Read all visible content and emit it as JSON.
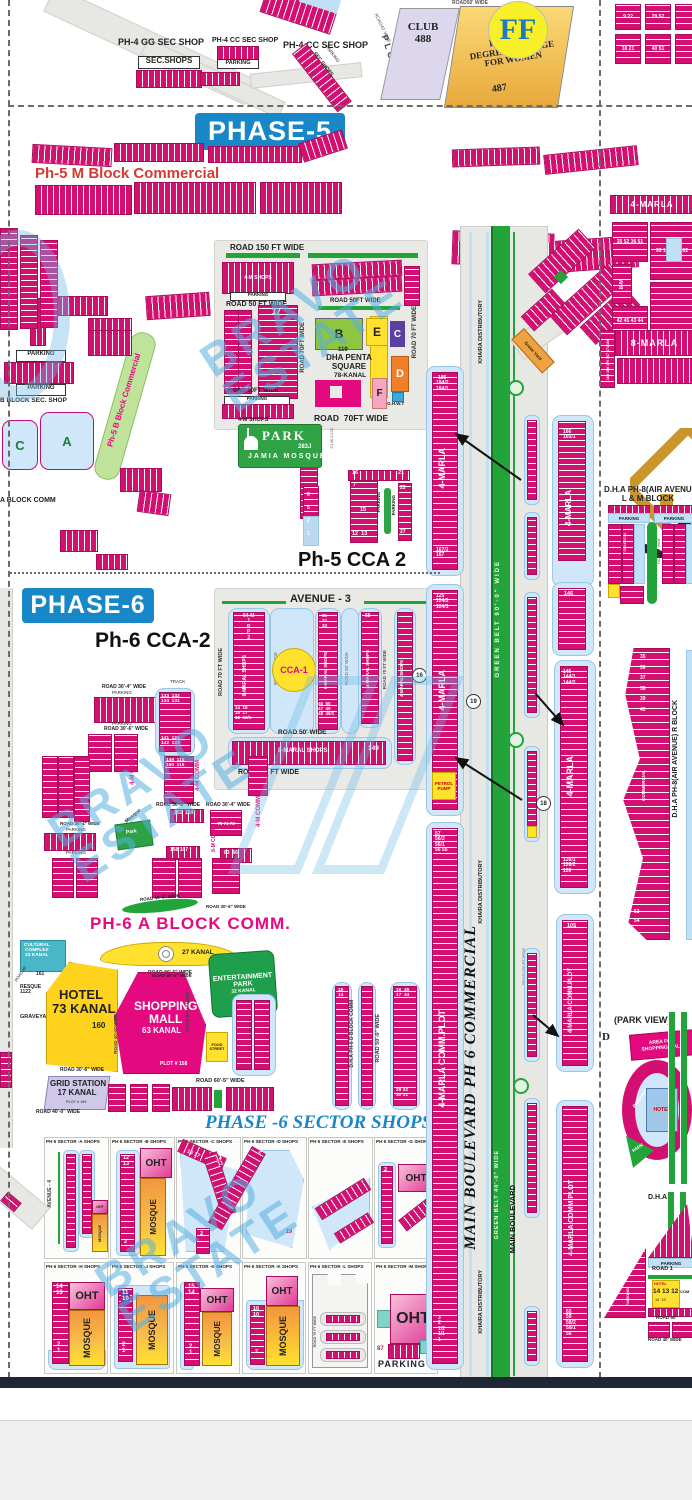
{
  "c": {
    "parking": "PARKING",
    "oht": "OHT",
    "mosque": "MOSQUE",
    "marla4": "4-MARLA",
    "marla8": "8-MARLA",
    "marla_comm": "4-MARLA COMM.PLOT",
    "khaira": "KHAIRA DISTRIBUTORY",
    "comm": "COMMERCIAL",
    "m4comm": "4-M COMM",
    "m8comm": "8-M COMM",
    "shops4m": "4-M SHOPS",
    "secshops": "SEC SHOPS"
  },
  "top": {
    "gg": "PH-4 GG SEC SHOP",
    "secshops": "SEC.SHOPS",
    "cc": "PH-4 CC SEC SHOP",
    "plots": "PLOTS",
    "club": "CLUB\n488",
    "road50": "ROAD50' WIDE",
    "road40": "ROAD40' WIDE",
    "college": "DEFENCE\nDEGREE COLLAGE\nFOR WOMEN",
    "college_num": "487",
    "ff": "FF",
    "g1": "18 21",
    "g2": "40 51",
    "g3": "9 22",
    "g4": "29 52"
  },
  "p5": {
    "title": "PHASE-5",
    "mblock": "Ph-5 M Block Commercial",
    "bblock": "Ph-5 B Block Commercial",
    "bsec": "B BLOCK SEC. SHOP",
    "ablock": "A BLOCK COMM",
    "cletter": "C",
    "aletter": "A",
    "road150": "ROAD 150 FT WIDE",
    "road50": "ROAD 50 FT WIDE",
    "road50v": "ROAD 50FT WIDE",
    "road70v": "ROAD 70FT WIDE",
    "road70": "ROAD  70FT WIDE",
    "road70r": "ROAD 70 FT WIDE",
    "cca": "CCA",
    "n17": "17"
  },
  "penta": {
    "num": "119",
    "name": "DHA PENTA\nSQUARE",
    "kanal": "78-KANAL",
    "pa": "A",
    "pb": "B",
    "pc": "C",
    "pd": "D",
    "pe": "E",
    "pf": "F",
    "ohwt": "O.H.W.T"
  },
  "park5": {
    "park": "PARK",
    "num": "283J",
    "mosque": "JAMIA MOSQUE",
    "c146": "C146-C125"
  },
  "cca25": {
    "title": "Ph-5 CCA 2",
    "n16": "16",
    "n21": "21",
    "n7": "7",
    "n15": "15",
    "n1213": "12  13",
    "n23": "23",
    "n27": "27",
    "col": "6\n5\n2\n1"
  },
  "p6": {
    "title": "PHASE-6",
    "cca2": "Ph-6 CCA-2",
    "avenue3": "AVENUE - 3",
    "cca1": "CCA-1",
    "track": "TRACK",
    "road304": "ROAD 30'-4\" WIDE",
    "road306": "ROAD 30'-6\" WIDE",
    "road70": "ROAD 70 FT WIDE",
    "road50": "ROAD 50' WIDE",
    "shops8m": "8-MARAL SHOPS",
    "shops4m": "4-MARAL SHOPS",
    "c1top": "64-M\n1\nP\nP\n2",
    "c1bot": "14  18\n15  17\n16  16/1",
    "c3top": "31\n32\n33",
    "c3bot": "46  50\n47  49\n48  46/1",
    "n65": "65",
    "n149": "149",
    "n16": "16",
    "blkA": "133  132\n134  131",
    "blkB": "141  124\n142  123",
    "blkC": "149  116\n150  115",
    "n151": "151  114",
    "n75": "75  74  73",
    "n83": "83  66",
    "n158": "158 107",
    "mosque": "Mosque",
    "park": "Park",
    "road500": "ROAD 50'-0\" WIDE",
    "dblock": "D.H.A PH-6 D BLOCK COMM",
    "d1": "15\n14",
    "d2": "16  45\n17  44",
    "d3": "29 32\n30 31"
  },
  "lm": {
    "ablock": "PH-6 A BLOCK COMM.",
    "cultural": "CULTURAL\nCOMPLEX\n23 KANAL",
    "cultural_num": "161",
    "kanal27": "27 KANAL",
    "road806": "ROAD 80'-6\" WIDE",
    "ent": "ENTERTAINMENT\nPARK",
    "ent_k": "32 KANAL",
    "resque": "RESQUE\n1122",
    "graveyard": "GRAVEYARD",
    "road40": "ROAD 40'",
    "hotel": "HOTEL\n73 KANAL",
    "hotel_num": "160",
    "mall": "SHOPPING\nMALL",
    "mall_k": "63 KANAL",
    "mall_plot": "PLOT # 158",
    "grid": "GRID STATION\n17 KANAL",
    "grid_plot": "PLOT # 159",
    "road306": "ROAD 30'-6\" WIDE",
    "road400": "ROAD 40'-0\" WIDE",
    "road605": "ROAD 60'-5\" WIDE",
    "food": "FOOD\nSTREET"
  },
  "ss": {
    "title": "PHASE -6 SECTOR SHOPS",
    "pa": "PH 6 SECTOR -A SHOPS",
    "pb": "PH 6 SECTOR -B SHOPS",
    "pc": "PH 6 SECTOR -C SHOPS",
    "pd": "PH 6 SECTOR -D SHOPS",
    "pe": "PH 6 SECTOR -E SHOPS",
    "pg": "PH 6 SECTOR -G SHOPS",
    "ph": "PH 6 SECTOR -H SHOPS",
    "pj": "PH 6 SECTOR -J SHOPS",
    "pk": "PH 6 SECTOR -K SHOPS",
    "pk2": "PH 6 SECTOR -K SHOPS",
    "pl": "PH 6 SECTOR -L SHOPS",
    "pm": "PH 6 SECTOR -M SHOPS",
    "avenue4": "AVENUE - 4",
    "b_top": "12\n13",
    "b_bot": "2",
    "c_n1": "16 17",
    "c_n2": "12\n11",
    "c_bot": "2",
    "d_top": "2",
    "d_bot": "19",
    "e_n": "2 1",
    "g_top": "2",
    "h_top": "14\n13",
    "h_bot": "2\n1",
    "j_top": "11\n10",
    "j_bot": "2\n1",
    "k_top": "15\n14",
    "k_bot": "2\n1",
    "k2_top": "16\n10",
    "k2_bot": "2",
    "road75": "ROAD 75 FT WIDE",
    "n87": "87",
    "n21": "2 1",
    "parking": "PARKING"
  },
  "cor": {
    "greenbelt": "GREEN BELT 90'-0\" WIDE",
    "greenbelt2": "GREEN BELT 40'-0\" WIDE",
    "mainblvd_comm": "MAIN BOULEVARD PH 6 COMMERCIAL",
    "mainblvd": "MAIN BOULEVARD",
    "road100": "ROAD 100 FT WIDE",
    "s1top": "185\n184/2\n184/1",
    "s1bot": "167/1\n167",
    "s2top": "125\n124/2\n124/1",
    "petrol": "PETROL\nPUMP",
    "s3top": "57\n56/2\n56/1\n56 55",
    "sbot": "3\n2\n1/2\n1/1\n1",
    "r1top": "166\n165/1",
    "r2top": "146",
    "r3top": "145\n144/1\n144/2",
    "r3bot": "126/1\n126/2\n126",
    "r4top": "105",
    "rbot": "60\n59\n58/2\n58/1\n56",
    "c13": "13",
    "c16": "16",
    "c18": "18",
    "c19": "19",
    "grave": "Grave Yard"
  },
  "r8": {
    "marla4": "4-MARLA",
    "marla8": "8-MARLA",
    "g1": "35  52\n36  51",
    "g2": "8-M",
    "g3": "42  45\n43  44",
    "g4": "93 103\n94 102",
    "g5": "169 168\n170 167\n171 166",
    "lm": "D.H.A PH-8(AIR AVENUE)\nL & M BLOCK",
    "rblock": "D.H.A PH-8(AIR AVENUE) R BLOCK",
    "rtop": "35\n36\n37\n38\n39\n40",
    "rbot": "53\n54",
    "road50": "ROAD 50' WIDE",
    "parkview": "(PARK VIEW)",
    "d": "D",
    "areamall": "AREA FOR\nSHOPPING MALL",
    "hotel": "HOTEL",
    "park": "PARK",
    "dha": "D.H.A",
    "hnum": "14 13 12",
    "hnum2": "16  15",
    "com": "COM",
    "road1": "ROAD 1",
    "road50b": "ROAD 50'",
    "road40": "ROAD 40' WIDE"
  },
  "wm": {
    "l1": "BRAVO",
    "l2": "ESTATE",
    "two": "BRAVO\nESTATE"
  }
}
